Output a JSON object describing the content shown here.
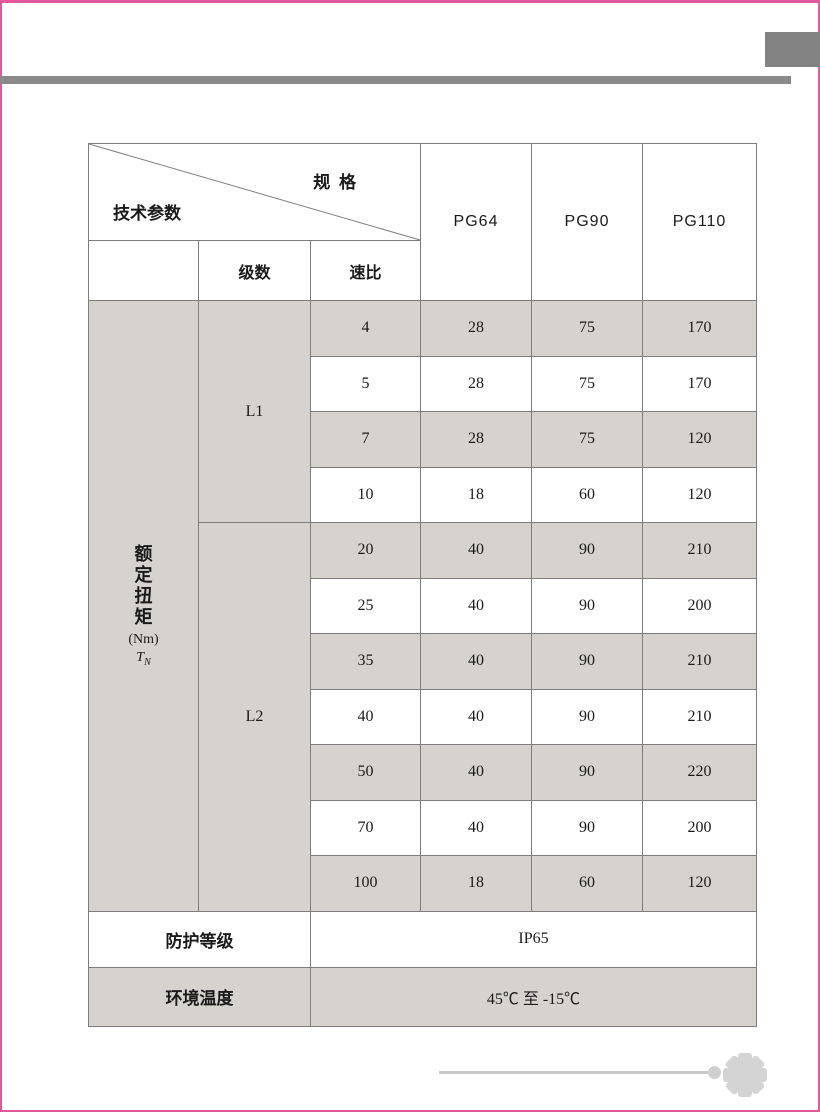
{
  "colors": {
    "accent_pink": "#e2589c",
    "decor_gray": "#8a8a8a",
    "row_shade": "#d6d3ce",
    "table_line": "#7d7d7d"
  },
  "table": {
    "corner": {
      "top_label": "规 格",
      "bottom_label": "技术参数"
    },
    "spec_columns": [
      "PG64",
      "PG90",
      "PG110"
    ],
    "subheader": {
      "stages": "级数",
      "ratio": "速比"
    },
    "torque_label": {
      "chars": "额定扭矩",
      "unit": "(Nm)",
      "symbol": "T",
      "symbol_sub": "N"
    },
    "groups": [
      {
        "label": "L1",
        "rows": [
          [
            "4",
            "28",
            "75",
            "170"
          ],
          [
            "5",
            "28",
            "75",
            "170"
          ],
          [
            "7",
            "28",
            "75",
            "120"
          ],
          [
            "10",
            "18",
            "60",
            "120"
          ]
        ]
      },
      {
        "label": "L2",
        "rows": [
          [
            "20",
            "40",
            "90",
            "210"
          ],
          [
            "25",
            "40",
            "90",
            "200"
          ],
          [
            "35",
            "40",
            "90",
            "210"
          ],
          [
            "40",
            "40",
            "90",
            "210"
          ],
          [
            "50",
            "40",
            "90",
            "220"
          ],
          [
            "70",
            "40",
            "90",
            "200"
          ],
          [
            "100",
            "18",
            "60",
            "120"
          ]
        ]
      }
    ],
    "footer_rows": [
      {
        "label": "防护等级",
        "value": "IP65"
      },
      {
        "label": "环境温度",
        "value": "45℃ 至 -15℃"
      }
    ]
  },
  "footer": {
    "page_number": "34",
    "badge_icon": "gear-icon"
  }
}
